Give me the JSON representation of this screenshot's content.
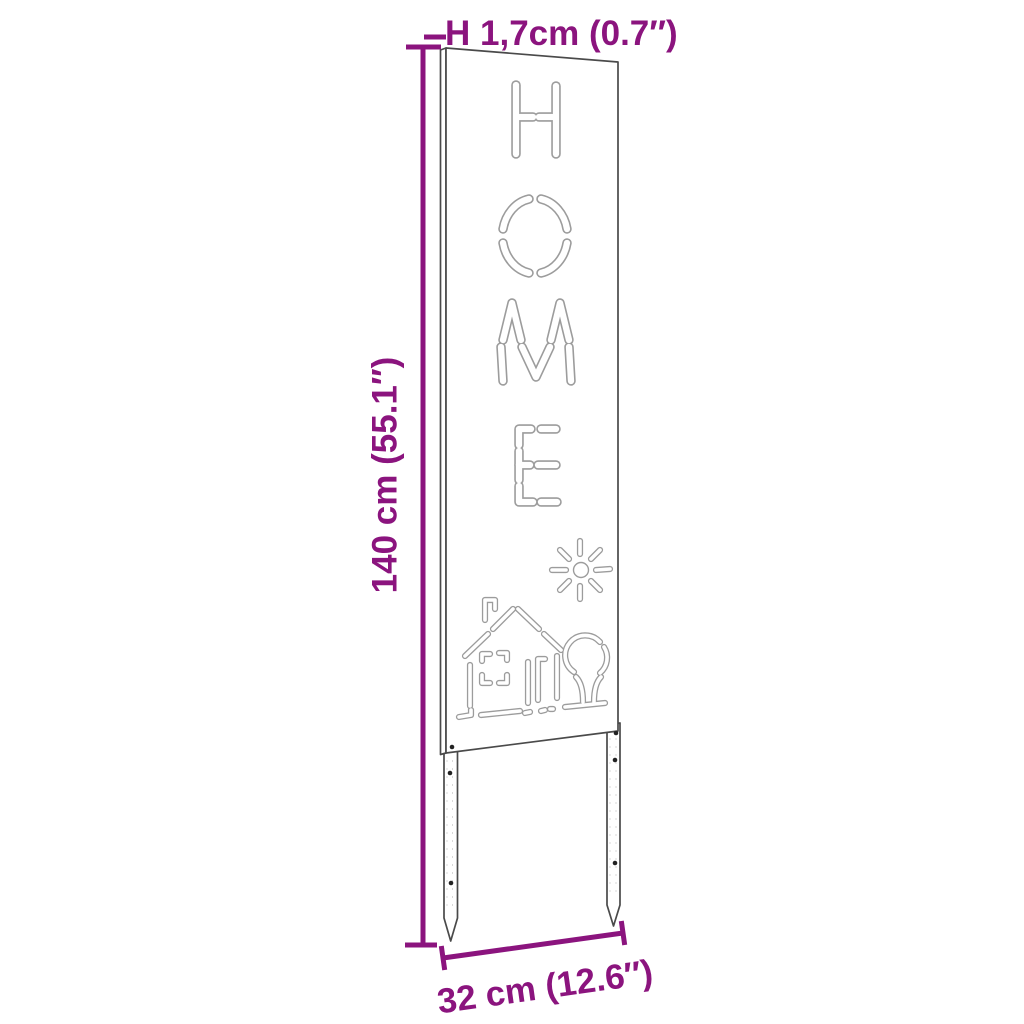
{
  "colors": {
    "accent": "#8B147E",
    "outline": "#4a4a4a",
    "cutout": "#9c9c9c",
    "background": "#ffffff"
  },
  "dimensions": {
    "thickness_label": "H 1,7cm (0.7″)",
    "height_label": "140 cm (55.1″)",
    "width_label": "32 cm (12.6″)"
  },
  "panel": {
    "cutout_word": "HOME",
    "motifs": [
      "sun",
      "house",
      "tree"
    ]
  }
}
